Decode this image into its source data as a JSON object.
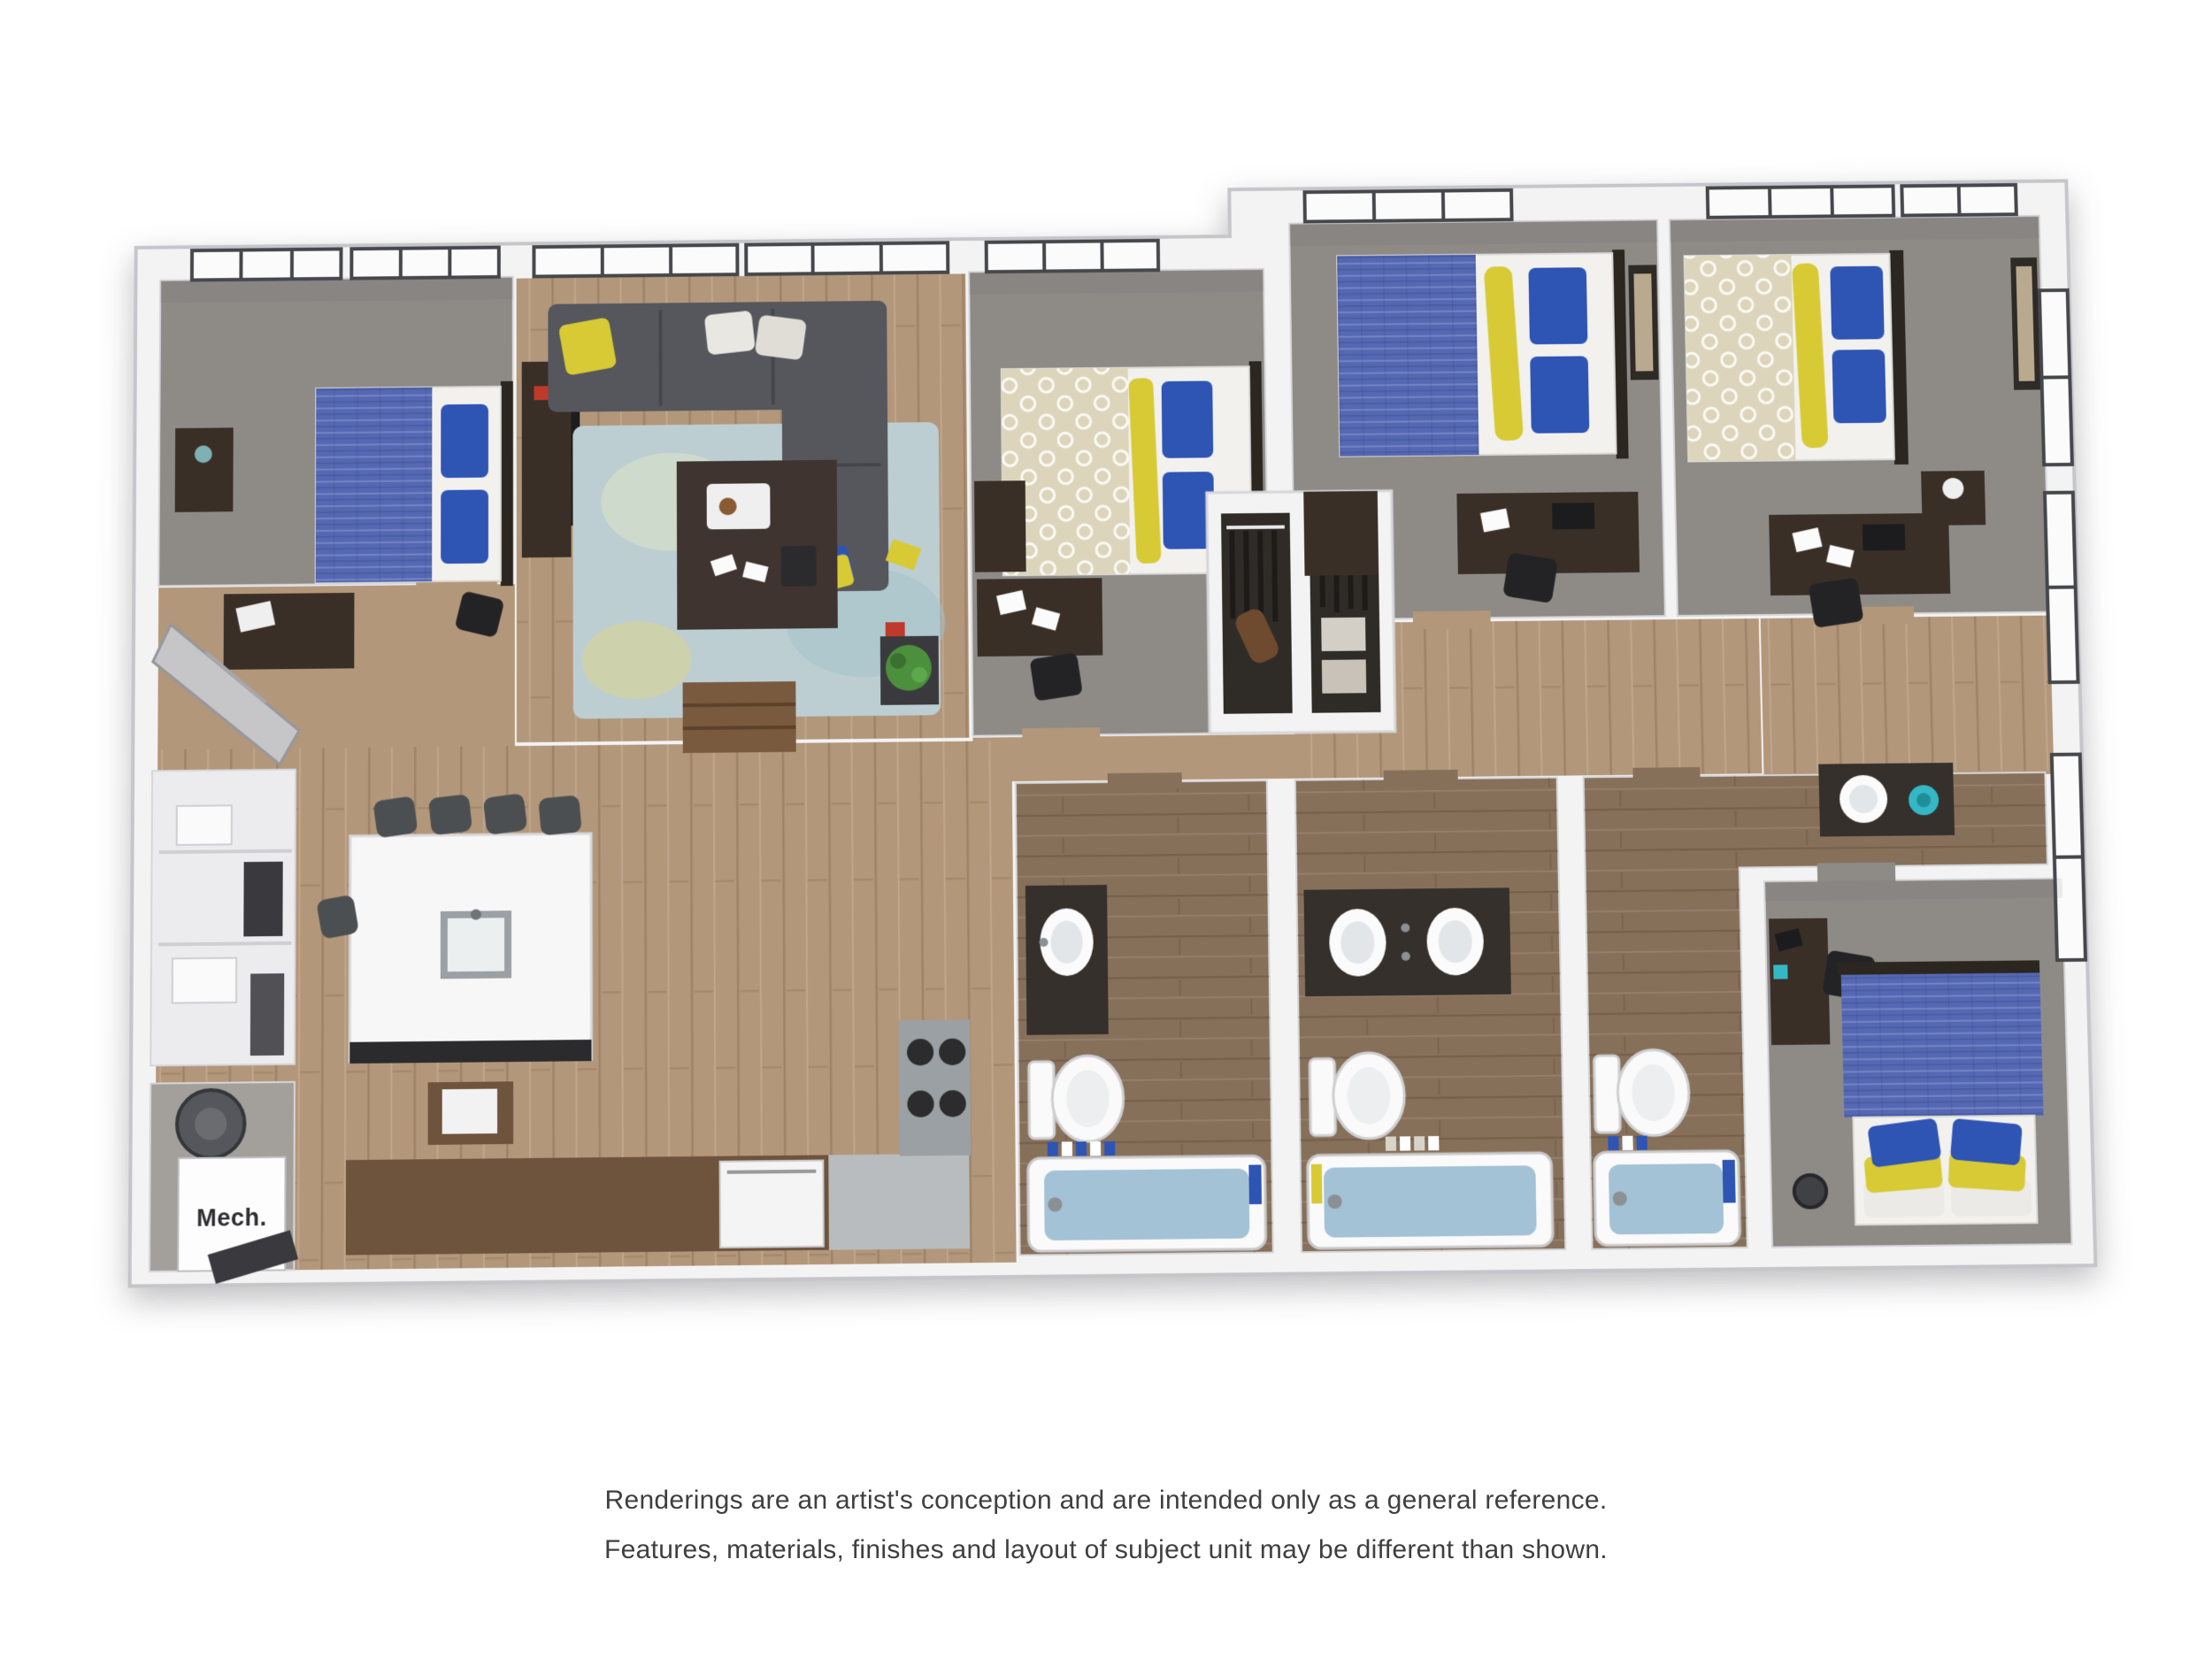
{
  "disclaimer": {
    "line1": "Renderings are an artist's conception and are intended only as a general reference.",
    "line2": "Features, materials, finishes and layout of subject unit may be different than shown."
  },
  "plan": {
    "mech_label": "Mech."
  },
  "palette": {
    "wall": "#f3f3f4",
    "wall_edge": "#c6c6ca",
    "inner_edge": "#d6d6d9",
    "carpet": "#8e8b87",
    "wood": "#b3977a",
    "wood_dark": "#87705a",
    "counter_wood": "#6e543c",
    "blue": "#5568b4",
    "pillow_blue": "#2e54b4",
    "yellow": "#d8ca35",
    "cream": "#ddd5bb",
    "sofa": "#56575d",
    "rug": "#bcced2",
    "espresso": "#3a2f27",
    "water": "#a4c2d6",
    "white_fixture": "#fafafa",
    "counter_gray": "#9aa0a3",
    "frame_dark": "#45474b",
    "teal": "#35b8c5",
    "green": "#4c8f3d",
    "text": "#3f3f3f"
  }
}
